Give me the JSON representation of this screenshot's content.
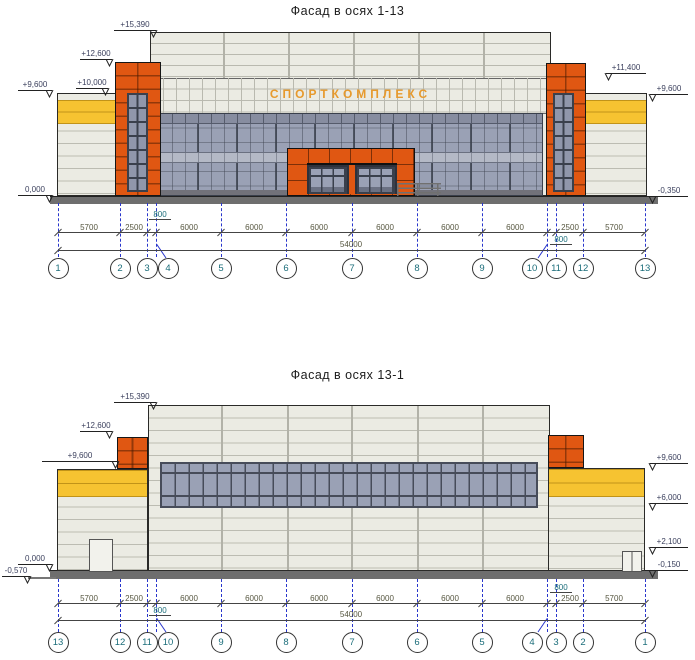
{
  "colors": {
    "orange": "#e05712",
    "yellow": "#f6c331",
    "wall": "#ebebe3",
    "wallLine": "#bcbcb2",
    "glass": "#9aa1b5",
    "glassLight": "#b4b9c6",
    "frameDark": "#3a404c",
    "plinth": "#6e6e6e",
    "axisBlue": "#2936cc",
    "axisText": "#1b6d7a",
    "dimText": "#56563f",
    "elevText": "#3c415e",
    "signColor": "#e79a2d"
  },
  "facade1": {
    "title": "Фасад в осях 1-13",
    "sign": "СПОРТКОМПЛЕКС",
    "elev_left": [
      "+15,390",
      "+12,600",
      "+10,000",
      "+9,600",
      "0,000"
    ],
    "elev_right": [
      "+11,400",
      "+9,600",
      "-0,350"
    ],
    "dims": [
      "5700",
      "2500",
      "6000",
      "6000",
      "6000",
      "6000",
      "6000",
      "6000",
      "2500",
      "5700"
    ],
    "dims_800": [
      "800",
      "800"
    ],
    "total": "54000",
    "axes": [
      "1",
      "2",
      "3",
      "4",
      "5",
      "6",
      "7",
      "8",
      "9",
      "10",
      "11",
      "12",
      "13"
    ]
  },
  "facade2": {
    "title": "Фасад в осях 13-1",
    "elev_left": [
      "+15,390",
      "+12,600",
      "+9,600",
      "0,000",
      "-0,570"
    ],
    "elev_right": [
      "+9,600",
      "+6,000",
      "+2,100",
      "-0,150"
    ],
    "dims": [
      "5700",
      "2500",
      "6000",
      "6000",
      "6000",
      "6000",
      "6000",
      "6000",
      "2500",
      "5700"
    ],
    "dims_800": [
      "800",
      "800"
    ],
    "total": "54000",
    "axes": [
      "13",
      "12",
      "11",
      "10",
      "9",
      "8",
      "7",
      "6",
      "5",
      "4",
      "3",
      "2",
      "1"
    ]
  }
}
